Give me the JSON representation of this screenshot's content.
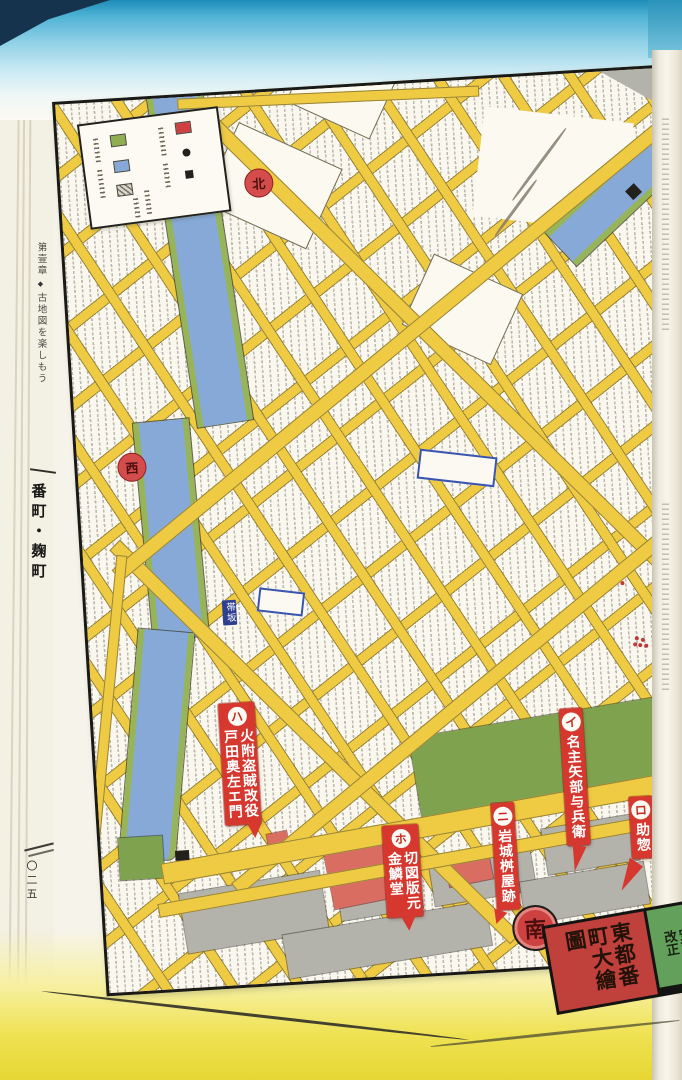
{
  "sidebar": {
    "chapter": "第壹章",
    "diamond": "◆",
    "chapter_title": "古地図を楽しもう",
    "section_title": "番町・麹町",
    "page_number": "〇二五"
  },
  "map": {
    "cartouche": {
      "edition": "安政改正",
      "title": "東都番町大繪圖"
    },
    "compass": {
      "north": "北",
      "west": "西",
      "east": "東",
      "south": "南"
    },
    "road_tag": "帯坂",
    "legend": {
      "swatches": [
        {
          "name": "green-square",
          "color": "#8fae52"
        },
        {
          "name": "blue-square",
          "color": "#86a9d7"
        },
        {
          "name": "hatched-square",
          "color": "#b8b4a8"
        },
        {
          "name": "red-square",
          "color": "#cf4040"
        },
        {
          "name": "black-dot",
          "color": "#23211c"
        },
        {
          "name": "black-square",
          "color": "#23211c"
        }
      ]
    },
    "markers": [
      {
        "id": "ha",
        "index": "ハ",
        "lines": [
          "火附盗賊改役",
          "戸田奥左エ門"
        ]
      },
      {
        "id": "ho",
        "index": "ホ",
        "lines": [
          "切図版元",
          "金鱗堂"
        ]
      },
      {
        "id": "ni",
        "index": "ニ",
        "lines": [
          "岩城桝屋跡"
        ]
      },
      {
        "id": "i",
        "index": "イ",
        "lines": [
          "名主矢部与兵衛"
        ]
      },
      {
        "id": "ro",
        "index": "ロ",
        "lines": [
          "助惣"
        ]
      }
    ]
  },
  "colors": {
    "road_yellow": "#efca43",
    "river_blue": "#86a9d7",
    "bank_green": "#97b459",
    "park_green": "#7fa24e",
    "block_gray": "#b3b3ab",
    "temple_red": "#d96d62",
    "marker_red": "#d6372e",
    "seal_red": "#cf4040",
    "cartouche_red": "#c0403c",
    "cartouche_green": "#63a05c",
    "page_top_blue": "#1d8cb8",
    "page_bottom_yellow": "#e6d633"
  }
}
